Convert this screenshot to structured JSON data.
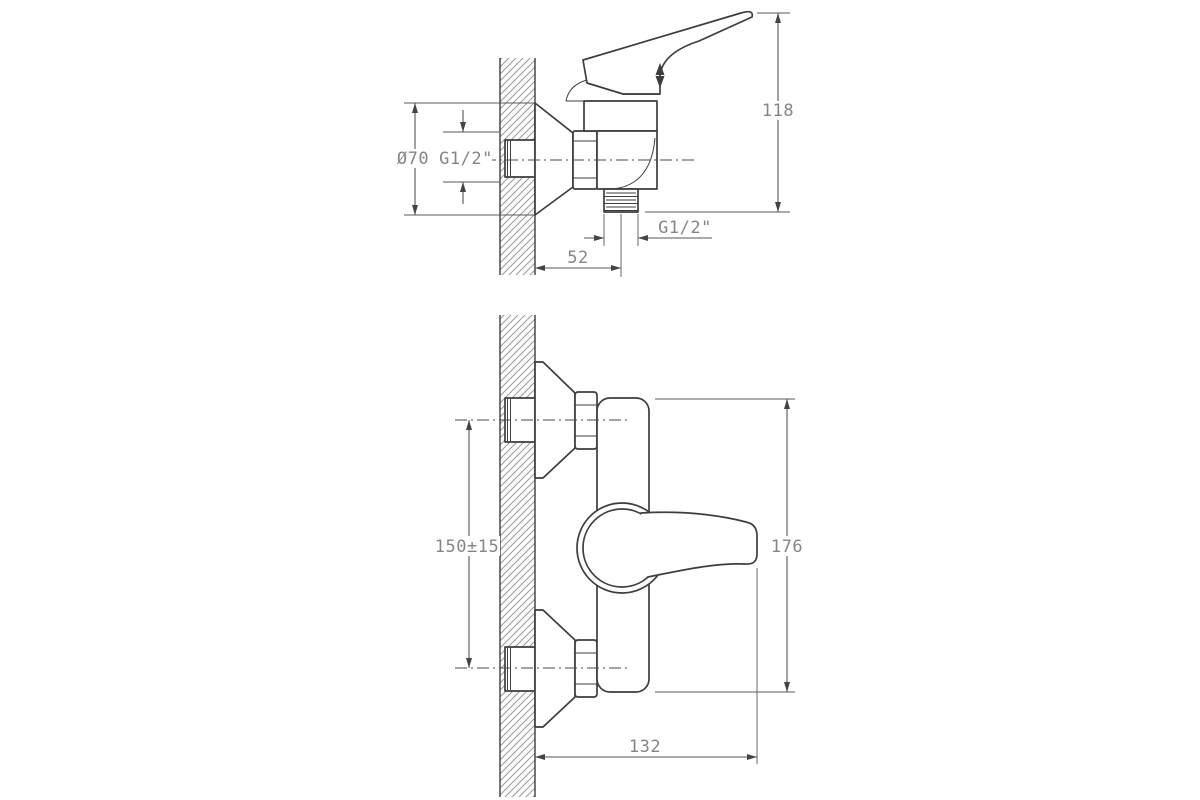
{
  "diagram": {
    "type": "technical-drawing",
    "subject": "wall-mounted single-lever shower mixer, two orthographic views with dimensions",
    "colors": {
      "background": "#ffffff",
      "outline": "#3d3d3d",
      "dimension_lines": "#555555",
      "label_text": "#858585",
      "wall_hatch": "#9a9a9a"
    },
    "views": {
      "side": {
        "dims": {
          "flange_diameter": "Ø70",
          "wall_thread": "G1/2\"",
          "overall_height": "118",
          "outlet_thread": "G1/2\"",
          "wall_to_outlet_center": "52"
        }
      },
      "front": {
        "dims": {
          "connection_spacing": "150±15",
          "overall_height": "176",
          "depth_from_wall": "132"
        }
      }
    }
  }
}
